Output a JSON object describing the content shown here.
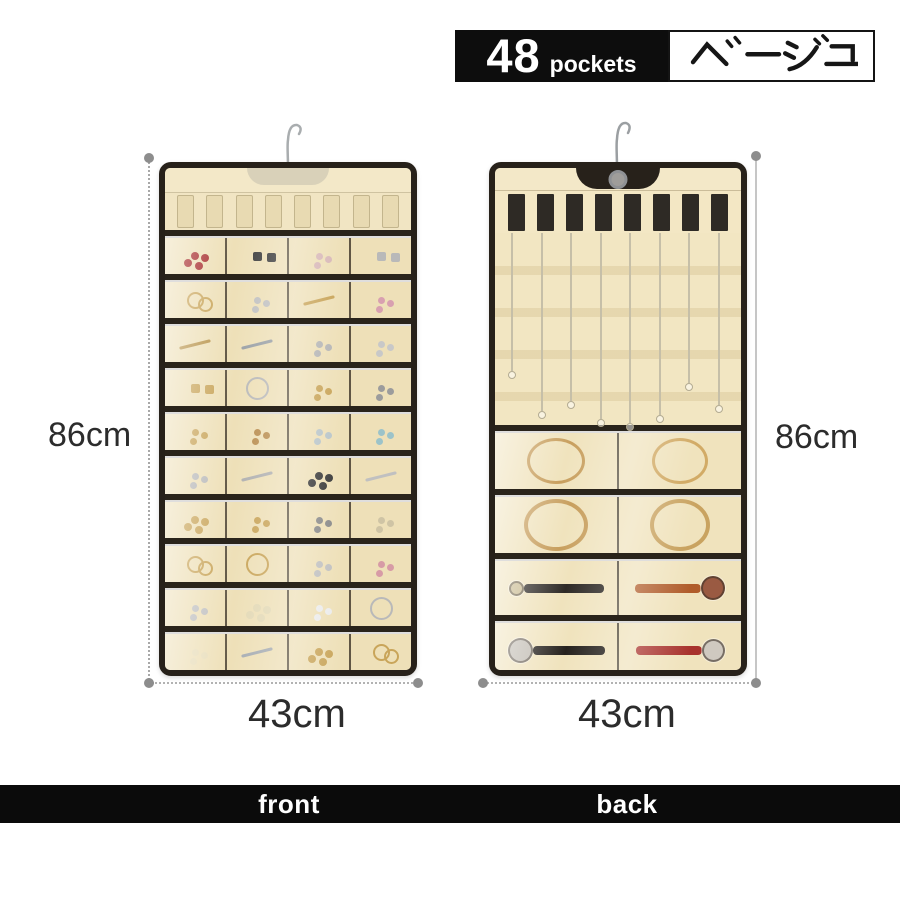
{
  "badge": {
    "count": "48",
    "unit": "pockets",
    "color_label": "ベージュ"
  },
  "dimensions": {
    "front_height": "86cm",
    "front_width": "43cm",
    "back_height": "86cm",
    "back_width": "43cm"
  },
  "footer": {
    "front_label": "front",
    "back_label": "back"
  },
  "colors": {
    "fabric_beige": "#f1e5c3",
    "trim_black": "#27211a",
    "badge_black": "#0d0d0d",
    "footer_black": "#0b0b0b",
    "dim_gray": "#8d8d8d"
  },
  "front_organizer": {
    "loops_count": 8,
    "rows": [
      [
        {
          "k": "beads",
          "c": "#a83030"
        },
        {
          "k": "pair",
          "c": "#3c3c3c"
        },
        {
          "k": "dots",
          "c": "#d8b8b8"
        },
        {
          "k": "pair",
          "c": "#b9b9b9"
        }
      ],
      [
        {
          "k": "ring",
          "c": "#c9a55a"
        },
        {
          "k": "dots",
          "c": "#c0c0c0"
        },
        {
          "k": "pin",
          "c": "#c9a55a"
        },
        {
          "k": "dots",
          "c": "#d8a0b0"
        }
      ],
      [
        {
          "k": "pin",
          "c": "#b8934a"
        },
        {
          "k": "pin",
          "c": "#9aa0a6"
        },
        {
          "k": "dots",
          "c": "#b5b5b5"
        },
        {
          "k": "dots",
          "c": "#c8c8c8"
        }
      ],
      [
        {
          "k": "pair",
          "c": "#c9a55a"
        },
        {
          "k": "hoop",
          "c": "#b9b9b9"
        },
        {
          "k": "dots",
          "c": "#c9a55a"
        },
        {
          "k": "dots",
          "c": "#9c9c9c"
        }
      ],
      [
        {
          "k": "dots",
          "c": "#c9a55a"
        },
        {
          "k": "dots",
          "c": "#b98d4f"
        },
        {
          "k": "dots",
          "c": "#b9c5c9"
        },
        {
          "k": "dots",
          "c": "#9cc3c9"
        }
      ],
      [
        {
          "k": "dots",
          "c": "#b9b9b9"
        },
        {
          "k": "pin",
          "c": "#b0b0b0"
        },
        {
          "k": "beads",
          "c": "#3a3a3a"
        },
        {
          "k": "pin",
          "c": "#c0c0c0"
        }
      ],
      [
        {
          "k": "beads",
          "c": "#c9a55a"
        },
        {
          "k": "dots",
          "c": "#c9a55a"
        },
        {
          "k": "dots",
          "c": "#8a8a8a"
        },
        {
          "k": "dots",
          "c": "#cfc4a5"
        }
      ],
      [
        {
          "k": "ring",
          "c": "#c9a55a"
        },
        {
          "k": "hoop",
          "c": "#c9a55a"
        },
        {
          "k": "dots",
          "c": "#c0c0c0"
        },
        {
          "k": "dots",
          "c": "#d79ba6"
        }
      ],
      [
        {
          "k": "dots",
          "c": "#c0c0c0"
        },
        {
          "k": "beads",
          "c": "#e3d9b6"
        },
        {
          "k": "dots",
          "c": "#ececec"
        },
        {
          "k": "hoop",
          "c": "#b9b9b9"
        }
      ],
      [
        {
          "k": "dots",
          "c": "#e8ddba"
        },
        {
          "k": "pin",
          "c": "#a7adb3"
        },
        {
          "k": "beads",
          "c": "#c9a55a"
        },
        {
          "k": "ring",
          "c": "#c9a55a"
        }
      ]
    ]
  },
  "back_organizer": {
    "velcro_tabs": 8,
    "necklace_lengths": [
      138,
      178,
      168,
      186,
      190,
      182,
      150,
      172
    ],
    "pocket_rows": [
      [
        {
          "type": "bangle",
          "color": "#c89f5e",
          "w": 52,
          "h": 40,
          "t": 3
        },
        {
          "type": "bangle",
          "color": "#d2ab66",
          "w": 50,
          "h": 40,
          "t": 3
        }
      ],
      [
        {
          "type": "bangle",
          "color": "#c89f5e",
          "w": 56,
          "h": 44,
          "t": 4
        },
        {
          "type": "bangle",
          "color": "#c9a360",
          "w": 52,
          "h": 44,
          "t": 4
        }
      ],
      [
        {
          "type": "watch",
          "strap": "#2e2a26",
          "face": "#c8b98f",
          "face_side": "left",
          "face_size": 11,
          "strap_len": 80
        },
        {
          "type": "watch",
          "strap": "#b05c2a",
          "face": "#9a5a42",
          "face_side": "right",
          "face_size": 20,
          "strap_len": 66
        }
      ],
      [
        {
          "type": "watch",
          "strap": "#26221e",
          "face": "#c2bdb4",
          "face_side": "left",
          "face_size": 21,
          "strap_len": 72
        },
        {
          "type": "watch",
          "strap": "#a8322c",
          "face": "#cfc9c0",
          "face_side": "right",
          "face_size": 19,
          "strap_len": 66
        }
      ]
    ]
  }
}
